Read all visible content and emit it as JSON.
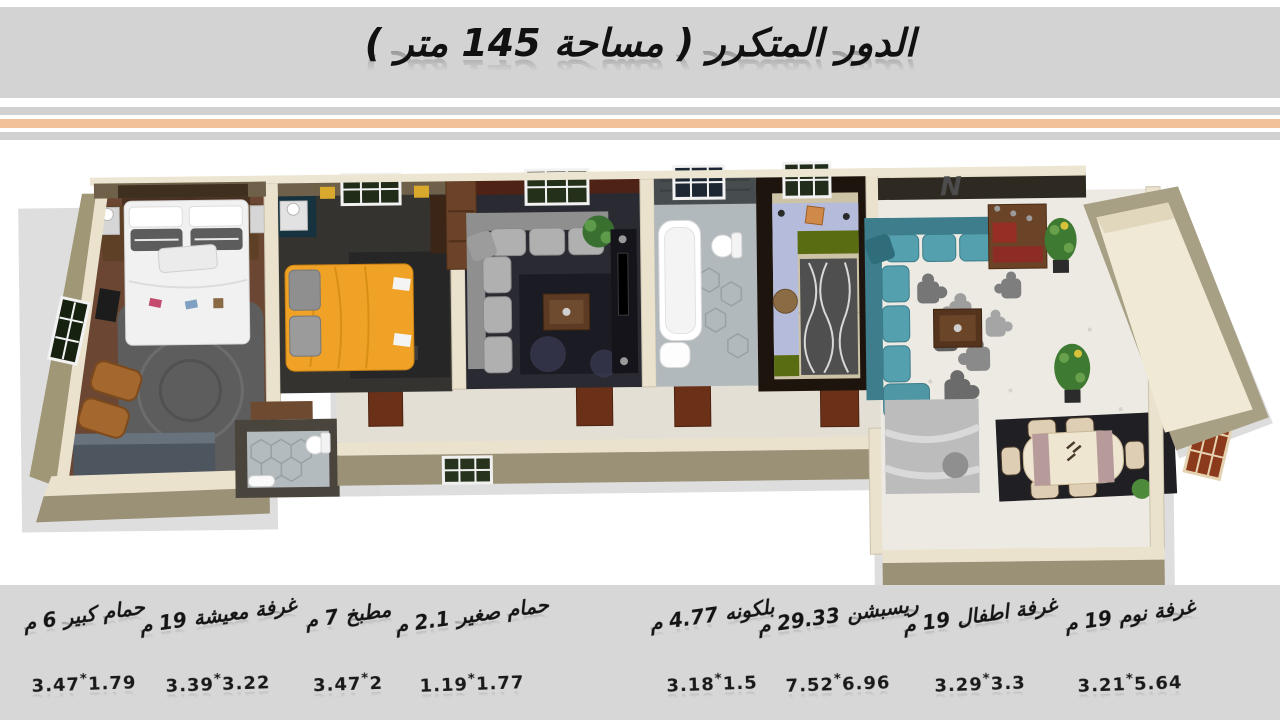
{
  "header": {
    "title": "الدور المتكرر ( مساحة 145 متر )"
  },
  "floorplan": {
    "north_label": "N"
  },
  "palette": {
    "header_gray": "#d3d3d3",
    "stripe_gray": "#d0d0d0",
    "stripe_peach": "#f2c19a",
    "footer_gray": "#d7d7d7",
    "wall_cream": "#eae2cd",
    "wall_khaki": "#a09776",
    "wood_floor": "#6b4733",
    "teal_sofa": "#55a0ae",
    "yellow_bed": "#efa226"
  },
  "legend": {
    "separator": "*",
    "items": [
      {
        "name": "حمام كبير 6 م",
        "w": "3.47",
        "h": "1.79"
      },
      {
        "name": "غرفة معيشة 19 م",
        "w": "3.39",
        "h": "3.22"
      },
      {
        "name": "مطبخ 7 م",
        "w": "3.47",
        "h": "2"
      },
      {
        "name": "حمام صغير 2.1 م",
        "w": "1.19",
        "h": "1.77"
      },
      {
        "name": "بلكونه 4.77 م",
        "w": "3.18",
        "h": "1.5"
      },
      {
        "name": "ريسبشن 29.33 م",
        "w": "7.52",
        "h": "6.96"
      },
      {
        "name": "غرفة اطفال 19 م",
        "w": "3.29",
        "h": "3.3"
      },
      {
        "name": "غرفة نوم 19 م",
        "w": "3.21",
        "h": "5.64"
      }
    ]
  }
}
